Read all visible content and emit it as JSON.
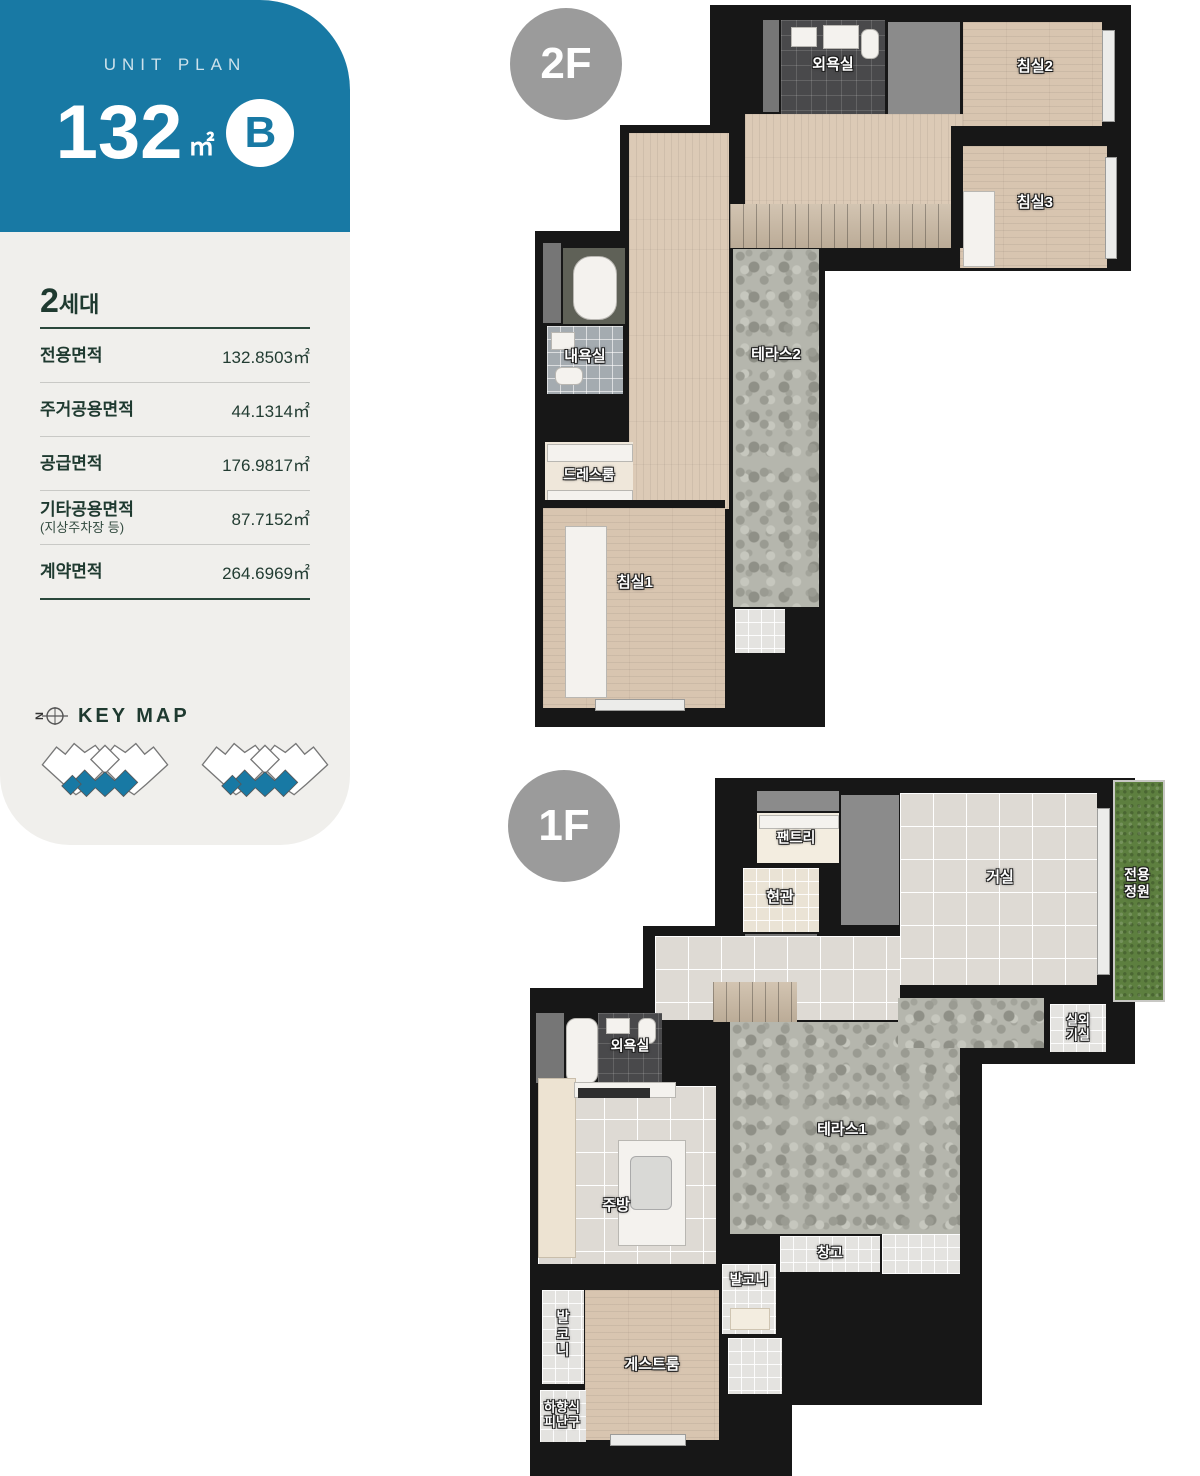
{
  "sidebar": {
    "eyebrow": "UNIT PLAN",
    "area": {
      "number": "132",
      "unit": "㎡",
      "type_letter": "B"
    },
    "household": {
      "count": "2",
      "label": "세대"
    },
    "table": {
      "rows": [
        {
          "label": "전용면적",
          "sub": "",
          "value": "132.8503㎡"
        },
        {
          "label": "주거공용면적",
          "sub": "",
          "value": "44.1314㎡"
        },
        {
          "label": "공급면적",
          "sub": "",
          "value": "176.9817㎡"
        },
        {
          "label": "기타공용면적",
          "sub": "(지상주차장 등)",
          "value": "87.7152㎡"
        },
        {
          "label": "계약면적",
          "sub": "",
          "value": "264.6969㎡"
        }
      ]
    },
    "keymap": {
      "title": "KEY MAP",
      "compass_letter": "N"
    }
  },
  "floor2": {
    "badge": "2F",
    "rooms": {
      "bath_out": "외욕실",
      "bed2": "침실2",
      "bed3": "침실3",
      "bath_in": "내욕실",
      "terrace2": "테라스2",
      "dress": "드레스룸",
      "bed1": "침실1"
    }
  },
  "floor1": {
    "badge": "1F",
    "rooms": {
      "pantry": "팬트리",
      "entry": "현관",
      "living": "거실",
      "garden": "전용\n정원",
      "outdoor_unit": "실외\n기실",
      "bath_out": "외욕실",
      "terrace1": "테라스1",
      "kitchen": "주방",
      "storage": "창고",
      "balcony_r": "발코니",
      "balcony_l": "발\n코\n니",
      "guest": "게스트룸",
      "escape": "하향식\n피난구"
    }
  },
  "colors": {
    "accent_blue": "#1879A4",
    "badge_gray": "#9B9B9B",
    "text_green": "#1F3A30"
  }
}
